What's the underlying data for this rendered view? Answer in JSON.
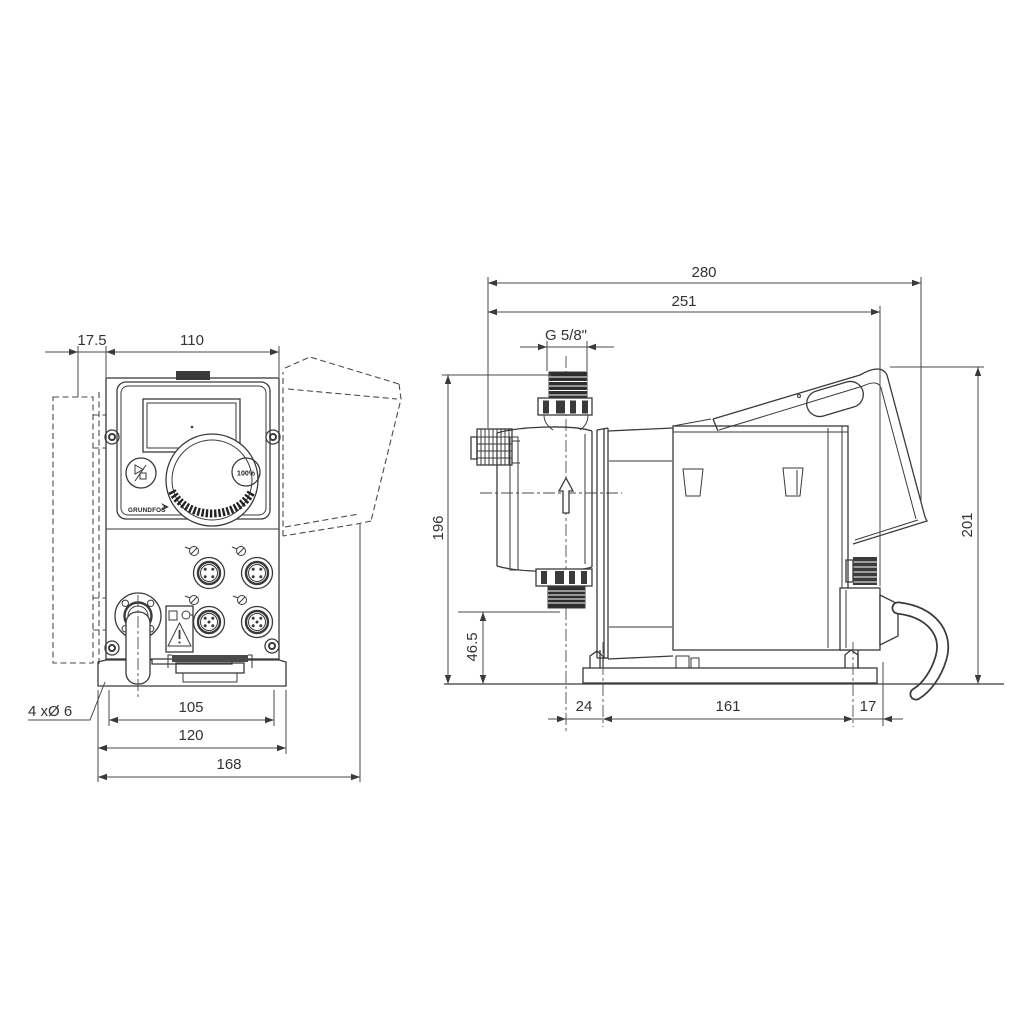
{
  "front_view": {
    "dim_wall_offset": "17.5",
    "dim_housing_width": "110",
    "dim_hole_spacing": "105",
    "dim_plate_width": "120",
    "dim_total_width": "168",
    "hole_note": "4 xØ 6",
    "panel": {
      "capacity_button": "100%",
      "logo": "GRUNDFOS"
    }
  },
  "side_view": {
    "dim_total_depth": "280",
    "dim_body_depth": "251",
    "dim_connection_thread": "G 5/8\"",
    "dim_height_to_connection": "196",
    "dim_suction_height": "46.5",
    "dim_total_height": "201",
    "dim_base_front_offset": "24",
    "dim_base_hole_spacing": "161",
    "dim_base_rear_offset": "17"
  }
}
